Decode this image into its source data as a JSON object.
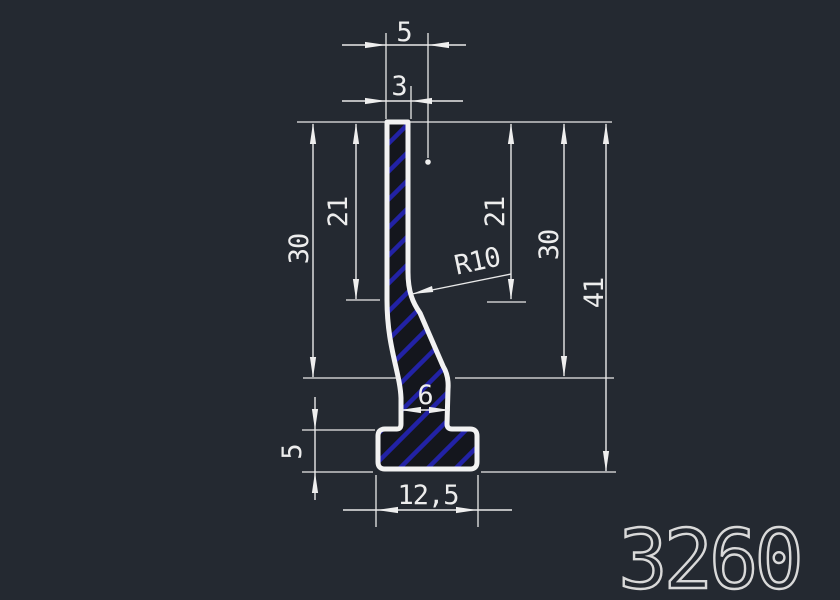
{
  "drawing": {
    "part_number": "3260",
    "dimensions": {
      "top_width": "5",
      "top_wall": "3",
      "left_upper_height": "21",
      "left_height": "30",
      "right_upper_height": "21",
      "right_height": "30",
      "total_height": "41",
      "fillet_radius": "R10",
      "neck_width": "6",
      "base_thickness": "5",
      "base_width": "12,5"
    },
    "colors": {
      "background": "#242931",
      "line": "#eeeeee",
      "hatch_blue": "#2222a6",
      "profile_fill": "#14161d",
      "part_number_color": "#d9d9d9"
    }
  }
}
